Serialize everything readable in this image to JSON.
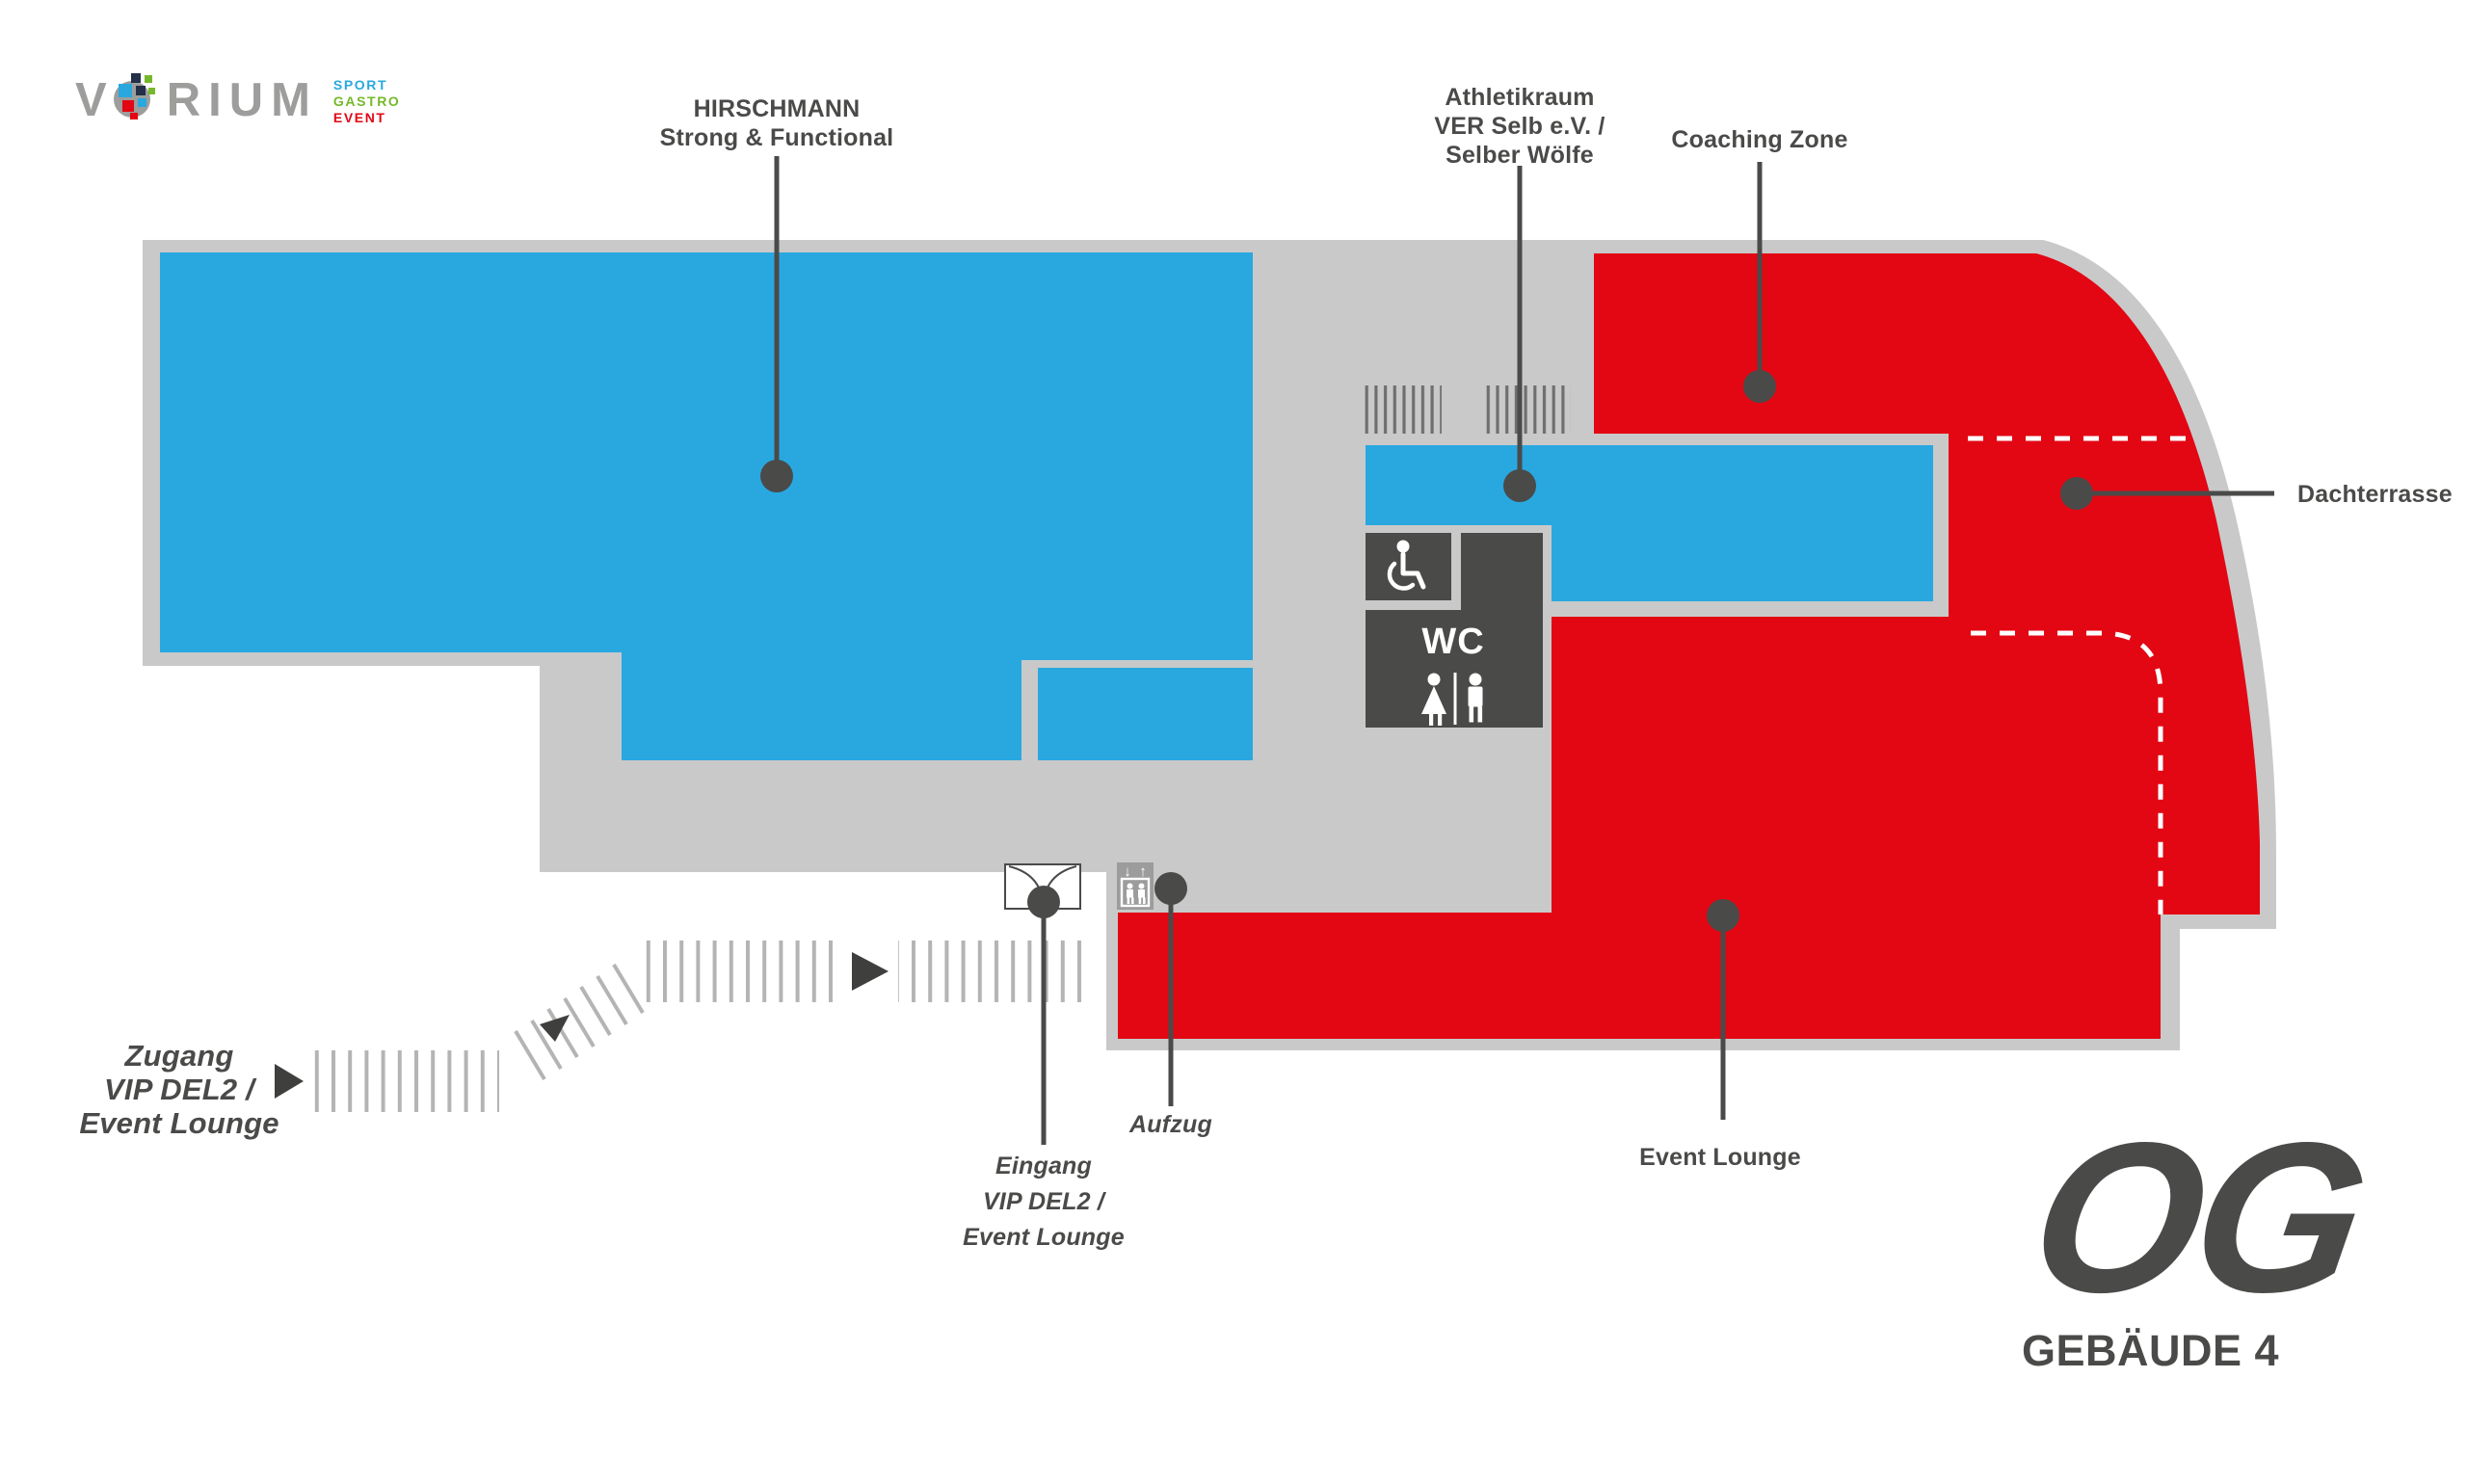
{
  "logo": {
    "brand_start": "V",
    "brand_end": "RIUM",
    "tagline": [
      "SPORT",
      "GASTRO",
      "EVENT"
    ]
  },
  "labels": {
    "hirschmann": [
      "HIRSCHMANN",
      "Strong & Functional"
    ],
    "athletikraum": [
      "Athletikraum",
      "VER Selb e.V. /",
      "Selber Wölfe"
    ],
    "coaching": "Coaching Zone",
    "dachterrasse": "Dachterrasse",
    "event_lounge": "Event Lounge",
    "aufzug": "Aufzug",
    "eingang": [
      "Eingang",
      "VIP DEL2 /",
      "Event Lounge"
    ],
    "zugang": [
      "Zugang",
      "VIP DEL2 /",
      "Event Lounge"
    ],
    "wc": "WC"
  },
  "floor_badge": {
    "level": "OG",
    "building": "GEBÄUDE 4"
  },
  "colors": {
    "room_blue": "#29a8e0",
    "room_red": "#e30613",
    "floor_gray": "#c9c9c9",
    "wc_dark": "#4a4a49",
    "label_dark": "#4a4a49",
    "logo_gray": "#9d9d9c",
    "logo_blue": "#29a8e0",
    "logo_green": "#76b82a",
    "logo_red": "#e30613",
    "logo_navy": "#233047"
  }
}
